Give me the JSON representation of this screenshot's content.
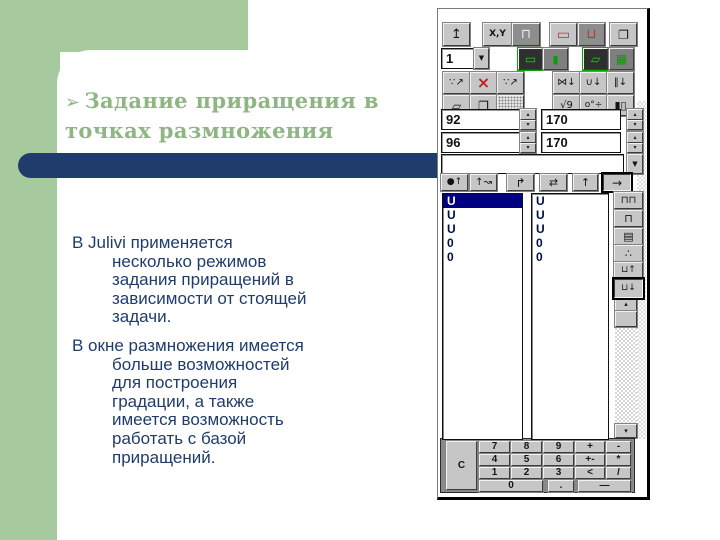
{
  "slide": {
    "colors": {
      "background_green": "#a6c99d",
      "accent_navy": "#1f3c6c",
      "title_green": "#8fb585",
      "body_navy": "#1f3c6c",
      "selection_navy": "#000080"
    },
    "title": {
      "bullet_icon": "➢",
      "lines": [
        "Задание приращения в",
        "точках размножения"
      ]
    },
    "body": {
      "paragraphs": [
        {
          "lines": [
            {
              "text": "В Julivi применяется",
              "indent": false
            },
            {
              "text": "несколько режимов",
              "indent": true
            },
            {
              "text": "задания приращений в",
              "indent": true
            },
            {
              "text": "зависимости от стоящей",
              "indent": true
            },
            {
              "text": "задачи.",
              "indent": true
            }
          ]
        },
        {
          "lines": [
            {
              "text": "В окне размножения имеется",
              "indent": false
            },
            {
              "text": "больше возможностей",
              "indent": true
            },
            {
              "text": "для построения",
              "indent": true
            },
            {
              "text": "градации, а также",
              "indent": true
            },
            {
              "text": "имеется возможность",
              "indent": true
            },
            {
              "text": "работать с базой",
              "indent": true
            },
            {
              "text": "приращений.",
              "indent": true
            }
          ]
        }
      ]
    }
  },
  "panel": {
    "dropdown": {
      "value": "1",
      "icon": "▼"
    },
    "combobox": {
      "value": "",
      "icon": "▼"
    },
    "spinner": {
      "up_icon": "▴",
      "down_icon": "▾"
    },
    "scrollbar": {
      "up_icon": "▴",
      "down_icon": "▾"
    },
    "buttons": [
      {
        "name": "paste-up-button",
        "glyph": "↥",
        "x": 5,
        "y": 14,
        "w": 27,
        "h": 23,
        "fs": 13
      },
      {
        "name": "xy-mode-button",
        "glyph": "X,Y",
        "x": 45,
        "y": 14,
        "w": 29,
        "h": 23,
        "fs": 9,
        "bold": true
      },
      {
        "name": "contour-mode-button",
        "glyph": "⊓",
        "x": 74,
        "y": 14,
        "w": 28,
        "h": 23,
        "style": "dark",
        "color": "#ececec",
        "fs": 13
      },
      {
        "name": "red-contour-button",
        "glyph": "▭",
        "x": 112,
        "y": 14,
        "w": 27,
        "h": 23,
        "color": "#c03232",
        "fs": 14
      },
      {
        "name": "red-u-button",
        "glyph": "⊔",
        "x": 140,
        "y": 14,
        "w": 27,
        "h": 23,
        "style": "dark",
        "color": "#c03232",
        "fs": 13
      },
      {
        "name": "copy-layers-button",
        "glyph": "❐",
        "x": 172,
        "y": 14,
        "w": 27,
        "h": 23,
        "fs": 12
      },
      {
        "name": "green-rect-button",
        "glyph": "▭",
        "x": 80,
        "y": 39,
        "w": 25,
        "h": 22,
        "style": "green-active",
        "color": "#17d517",
        "fs": 12
      },
      {
        "name": "green-bar-button",
        "glyph": "▮",
        "x": 105,
        "y": 39,
        "w": 25,
        "h": 22,
        "style": "green-dim",
        "color": "#0f9a0f",
        "fs": 11
      },
      {
        "name": "green-draw-button",
        "glyph": "▱",
        "x": 145,
        "y": 39,
        "w": 25,
        "h": 22,
        "style": "green-active",
        "color": "#17d517",
        "fs": 12
      },
      {
        "name": "green-grid-button",
        "glyph": "▦",
        "x": 171,
        "y": 39,
        "w": 25,
        "h": 22,
        "style": "green-dim",
        "color": "#0f9a0f",
        "fs": 12
      },
      {
        "name": "spread-points-button",
        "glyph": "∵↗",
        "x": 5,
        "y": 63,
        "w": 27,
        "h": 22,
        "fs": 10
      },
      {
        "name": "delete-spread-button",
        "glyph": "×",
        "x": 32,
        "y": 63,
        "w": 27,
        "h": 22,
        "color": "#c42020",
        "fs": 16,
        "bold": true
      },
      {
        "name": "spread-points-alt-button",
        "glyph": "∵↗",
        "x": 59,
        "y": 63,
        "w": 27,
        "h": 22,
        "fs": 10
      },
      {
        "name": "mirror-pin-button",
        "glyph": "⋈↓",
        "x": 115,
        "y": 63,
        "w": 27,
        "h": 22,
        "fs": 10
      },
      {
        "name": "rotate-pin-button",
        "glyph": "∪↓",
        "x": 142,
        "y": 63,
        "w": 27,
        "h": 22,
        "fs": 10
      },
      {
        "name": "parallel-pin-button",
        "glyph": "‖↓",
        "x": 169,
        "y": 63,
        "w": 27,
        "h": 22,
        "fs": 10
      },
      {
        "name": "cube-button",
        "glyph": "▱",
        "x": 5,
        "y": 86,
        "w": 27,
        "h": 21,
        "fs": 12
      },
      {
        "name": "cubes-stack-button",
        "glyph": "❐",
        "x": 32,
        "y": 86,
        "w": 27,
        "h": 21,
        "fs": 12
      },
      {
        "name": "hatch-pattern-button",
        "glyph": "",
        "x": 59,
        "y": 86,
        "w": 27,
        "h": 21,
        "style": "hatch"
      },
      {
        "name": "sqrt-nine-button",
        "glyph": "√9",
        "x": 115,
        "y": 86,
        "w": 27,
        "h": 21,
        "fs": 10
      },
      {
        "name": "angle-divide-button",
        "glyph": "o°÷",
        "x": 142,
        "y": 86,
        "w": 27,
        "h": 21,
        "fs": 9
      },
      {
        "name": "dark-squares-button",
        "glyph": "▮▯",
        "x": 169,
        "y": 86,
        "w": 27,
        "h": 21,
        "fs": 11
      },
      {
        "name": "point-up-arrow-button",
        "glyph": "●↑",
        "x": 3,
        "y": 165,
        "w": 27,
        "h": 17,
        "fs": 9
      },
      {
        "name": "zigzag-arrow-button",
        "glyph": "↑↝",
        "x": 32,
        "y": 165,
        "w": 27,
        "h": 17,
        "fs": 10
      },
      {
        "name": "corner-arrow-button",
        "glyph": "↱",
        "x": 69,
        "y": 165,
        "w": 27,
        "h": 17,
        "fs": 12
      },
      {
        "name": "swap-arrow-button",
        "glyph": "⇄",
        "x": 102,
        "y": 165,
        "w": 27,
        "h": 17,
        "fs": 11
      },
      {
        "name": "up-arrow-button",
        "glyph": "↑",
        "x": 135,
        "y": 165,
        "w": 25,
        "h": 17,
        "fs": 11
      },
      {
        "name": "right-arrow-button",
        "glyph": "→",
        "x": 165,
        "y": 165,
        "w": 28,
        "h": 17,
        "style": "pressed",
        "fs": 12
      },
      {
        "name": "tables-xy-button",
        "glyph": "⊓⊓",
        "x": 176,
        "y": 183,
        "w": 29,
        "h": 17,
        "fs": 10
      },
      {
        "name": "table-xy-button",
        "glyph": "⊓",
        "x": 176,
        "y": 201,
        "w": 29,
        "h": 17,
        "fs": 11
      },
      {
        "name": "sum-table-button",
        "glyph": "▤",
        "x": 176,
        "y": 219,
        "w": 29,
        "h": 17,
        "fs": 11
      },
      {
        "name": "scatter-points-button",
        "glyph": "∴",
        "x": 176,
        "y": 236,
        "w": 29,
        "h": 17,
        "fs": 11
      },
      {
        "name": "db-save-button",
        "glyph": "⊔↑",
        "x": 176,
        "y": 253,
        "w": 29,
        "h": 17,
        "fs": 9
      },
      {
        "name": "db-open-button",
        "glyph": "⊔↓",
        "x": 176,
        "y": 270,
        "w": 29,
        "h": 19,
        "style": "pressed",
        "fs": 9
      }
    ],
    "spin_fields": [
      {
        "name": "increment-field-1",
        "value": "92",
        "x": 3,
        "y": 100,
        "w": 79,
        "h": 21,
        "sx": 82
      },
      {
        "name": "increment-field-2",
        "value": "170",
        "x": 103,
        "y": 100,
        "w": 80,
        "h": 21,
        "sx": 189
      },
      {
        "name": "increment-field-3",
        "value": "96",
        "x": 3,
        "y": 123,
        "w": 79,
        "h": 21,
        "sx": 82
      },
      {
        "name": "increment-field-4",
        "value": "170",
        "x": 103,
        "y": 123,
        "w": 80,
        "h": 21,
        "sx": 189
      }
    ],
    "lists": [
      {
        "name": "increments-list-1",
        "x": 4,
        "y": 184,
        "w": 81,
        "h": 247,
        "items": [
          "U",
          "U",
          "U",
          "0",
          "0"
        ],
        "selected_index": 0
      },
      {
        "name": "increments-list-2",
        "x": 93,
        "y": 184,
        "w": 78,
        "h": 247,
        "items": [
          "U",
          "U",
          "U",
          "0",
          "0"
        ],
        "selected_index": -1
      }
    ],
    "keypad": {
      "keys": [
        {
          "label": "C",
          "x": 8,
          "y": 432,
          "w": 31,
          "h": 49
        },
        {
          "label": "7",
          "x": 41,
          "y": 432,
          "w": 31,
          "h": 12
        },
        {
          "label": "8",
          "x": 73,
          "y": 432,
          "w": 31,
          "h": 12
        },
        {
          "label": "9",
          "x": 105,
          "y": 432,
          "w": 31,
          "h": 12
        },
        {
          "label": "+",
          "x": 137,
          "y": 432,
          "w": 30,
          "h": 12
        },
        {
          "label": "-",
          "x": 168,
          "y": 432,
          "w": 25,
          "h": 12
        },
        {
          "label": "4",
          "x": 41,
          "y": 445,
          "w": 31,
          "h": 12
        },
        {
          "label": "5",
          "x": 73,
          "y": 445,
          "w": 31,
          "h": 12
        },
        {
          "label": "6",
          "x": 105,
          "y": 445,
          "w": 31,
          "h": 12
        },
        {
          "label": "+-",
          "x": 137,
          "y": 445,
          "w": 30,
          "h": 12
        },
        {
          "label": "*",
          "x": 168,
          "y": 445,
          "w": 25,
          "h": 12
        },
        {
          "label": "1",
          "x": 41,
          "y": 458,
          "w": 31,
          "h": 12
        },
        {
          "label": "2",
          "x": 73,
          "y": 458,
          "w": 31,
          "h": 12
        },
        {
          "label": "3",
          "x": 105,
          "y": 458,
          "w": 31,
          "h": 12
        },
        {
          "label": "<",
          "x": 137,
          "y": 458,
          "w": 30,
          "h": 12
        },
        {
          "label": "/",
          "x": 168,
          "y": 458,
          "w": 25,
          "h": 12
        },
        {
          "label": "0",
          "x": 41,
          "y": 471,
          "w": 64,
          "h": 12
        },
        {
          "label": ".",
          "x": 110,
          "y": 471,
          "w": 26,
          "h": 12
        },
        {
          "label": "—",
          "x": 140,
          "y": 471,
          "w": 53,
          "h": 12
        }
      ]
    }
  }
}
